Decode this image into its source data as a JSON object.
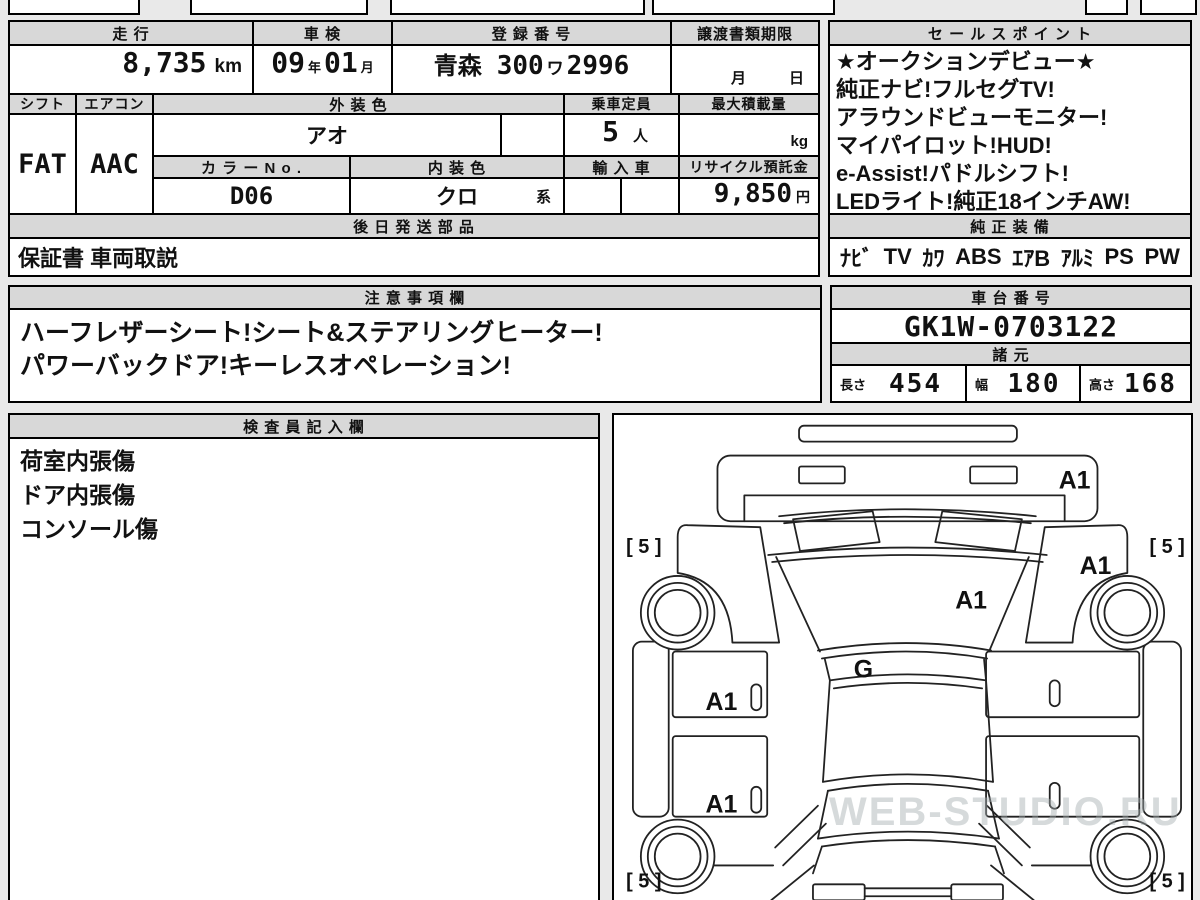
{
  "registration_table": {
    "col_headers": [
      "走 行",
      "車 検",
      "登 録 番 号",
      "譲渡書類期限"
    ],
    "mileage": {
      "value": "8,735",
      "unit": "km"
    },
    "shaken": {
      "year": "09",
      "year_unit": "年",
      "month": "01",
      "month_unit": "月"
    },
    "registration_no": {
      "area": "青森",
      "class": "300",
      "kana": "ワ",
      "number": "2996"
    },
    "transfer_deadline": {
      "month_label": "月",
      "day_label": "日"
    },
    "shift": {
      "label": "シフト",
      "value": "FAT"
    },
    "aircon": {
      "label": "エアコン",
      "value": "AAC"
    },
    "exterior_color": {
      "label": "外 装 色",
      "value": "アオ"
    },
    "capacity": {
      "label": "乗車定員",
      "value": "5",
      "unit": "人"
    },
    "max_load": {
      "label": "最大積載量",
      "value": "",
      "unit": "kg"
    },
    "color_no": {
      "label": "カ ラ ー N o .",
      "value": "D06"
    },
    "interior_color": {
      "label": "内 装 色",
      "value": "クロ",
      "suffix": "系"
    },
    "import_car": {
      "label": "輸 入 車",
      "value": ""
    },
    "recycle_deposit": {
      "label": "リサイクル預託金",
      "value": "9,850",
      "unit": "円"
    },
    "later_shipping": {
      "label": "後 日 発 送 部 品",
      "value": "保証書 車両取説"
    }
  },
  "sales_points": {
    "title": "セ ー ル ス ポ イ ン ト",
    "lines": [
      "★オークションデビュー★",
      "純正ナビ!フルセグTV!",
      "アラウンドビューモニター!",
      "マイパイロット!HUD!",
      "e-Assist!パドルシフト!",
      "LEDライト!純正18インチAW!"
    ]
  },
  "equipment": {
    "title": "純 正 装 備",
    "items": [
      "ﾅﾋﾞ",
      "TV",
      "ｶﾜ",
      "ABS",
      "ｴｱB",
      "ｱﾙﾐ",
      "PS",
      "PW"
    ]
  },
  "notes": {
    "title": "注 意 事 項 欄",
    "lines": [
      "ハーフレザーシート!シート&ステアリングヒーター!",
      "パワーバックドア!キーレスオペレーション!"
    ]
  },
  "chassis": {
    "title": "車 台 番 号",
    "value": "GK1W-0703122"
  },
  "specs": {
    "title": "諸 元",
    "dims": [
      {
        "label": "長さ",
        "value": "454"
      },
      {
        "label": "幅",
        "value": "180"
      },
      {
        "label": "高さ",
        "value": "168"
      }
    ]
  },
  "inspector_notes": {
    "title": "検 査 員 記 入 欄",
    "lines": [
      "荷室内張傷",
      "ドア内張傷",
      "コンソール傷"
    ]
  },
  "diagram": {
    "labels": {
      "bumper": "A1",
      "right_fender": "A1",
      "hood": "A1",
      "glass": "G",
      "front_door": "A1",
      "rear_door": "A1",
      "tire_front_left": "[ 5 ]",
      "tire_front_right": "[ 5 ]",
      "tire_rear_left": "[ 5 ]",
      "tire_rear_right": "[ 5 ]"
    },
    "watermark": "WEB-STUDIO.RU"
  }
}
